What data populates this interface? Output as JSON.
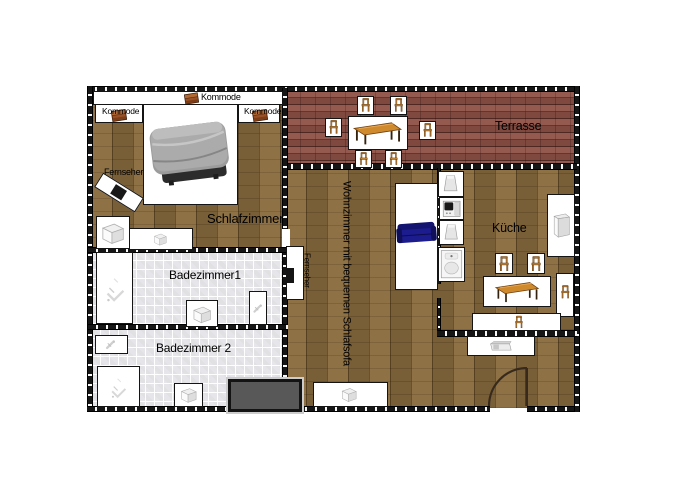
{
  "meta": {
    "type": "apartment-floor-plan",
    "background": "#ffffff",
    "width": 700,
    "height": 500
  },
  "colors": {
    "wood_floor": "#85683c",
    "brick_terrace": "#8e5146",
    "tile_bath": "#e6e6ea",
    "wall": "#161616",
    "furniture_fill": "#ffffff",
    "outline": "#141414",
    "sofa_blue": "#1c1c8e",
    "chair_tan": "#c08136",
    "table_top": "#d08a2e",
    "kommode_brown": "#9a5125",
    "platform_gray": "#585858",
    "tv_black": "#141414"
  },
  "rooms": [
    {
      "name": "schlafzimmer",
      "floor": "wood",
      "x": 91,
      "y": 91,
      "w": 195,
      "h": 160
    },
    {
      "name": "terrasse",
      "floor": "brick",
      "x": 285,
      "y": 91,
      "w": 291,
      "h": 77
    },
    {
      "name": "wohnzimmer",
      "floor": "wood",
      "x": 285,
      "y": 166,
      "w": 292,
      "h": 242
    },
    {
      "name": "badezimmer1",
      "floor": "tile",
      "x": 91,
      "y": 251,
      "w": 192,
      "h": 76
    },
    {
      "name": "badezimmer2",
      "floor": "tile",
      "x": 91,
      "y": 329,
      "w": 192,
      "h": 79
    }
  ],
  "walls": [
    {
      "name": "wall-top",
      "o": "h",
      "x": 87,
      "y": 86,
      "w": 493,
      "h": 6
    },
    {
      "name": "wall-left",
      "o": "v",
      "x": 87,
      "y": 86,
      "w": 6,
      "h": 326
    },
    {
      "name": "wall-bottom-left",
      "o": "h",
      "x": 87,
      "y": 406,
      "w": 403,
      "h": 6
    },
    {
      "name": "wall-bottom-right",
      "o": "h",
      "x": 527,
      "y": 406,
      "w": 53,
      "h": 6
    },
    {
      "name": "wall-right",
      "o": "v",
      "x": 574,
      "y": 86,
      "w": 6,
      "h": 326
    },
    {
      "name": "wall-terrace-bottom",
      "o": "h",
      "x": 283,
      "y": 163,
      "w": 294,
      "h": 7
    },
    {
      "name": "wall-bedroom-right",
      "o": "v",
      "x": 282,
      "y": 88,
      "w": 6,
      "h": 141
    },
    {
      "name": "wall-bath-right",
      "o": "v",
      "x": 282,
      "y": 247,
      "w": 6,
      "h": 137
    },
    {
      "name": "wall-bedroom-bottom",
      "o": "h",
      "x": 88,
      "y": 247,
      "w": 200,
      "h": 6
    },
    {
      "name": "wall-bath-divider",
      "o": "h",
      "x": 88,
      "y": 324,
      "w": 200,
      "h": 6
    },
    {
      "name": "wall-kitchen-left-a",
      "o": "v",
      "x": 437,
      "y": 168,
      "w": 4,
      "h": 116
    },
    {
      "name": "wall-kitchen-left-b",
      "o": "v",
      "x": 437,
      "y": 298,
      "w": 4,
      "h": 36
    },
    {
      "name": "wall-kitchen-bottom",
      "o": "h",
      "x": 437,
      "y": 330,
      "w": 140,
      "h": 7
    }
  ],
  "door_gaps": [
    {
      "name": "door-gap-bedroom-living",
      "x": 282,
      "y": 229,
      "w": 8,
      "h": 18
    }
  ],
  "furniture": [
    {
      "t": "box",
      "name": "closet-strip",
      "x": 93,
      "y": 91,
      "w": 190,
      "h": 14
    },
    {
      "t": "kommode",
      "name": "kommode-icon-top",
      "x": 184,
      "y": 92,
      "w": 15,
      "h": 13
    },
    {
      "t": "box",
      "name": "kommode-box-left",
      "x": 95,
      "y": 104,
      "w": 48,
      "h": 19
    },
    {
      "t": "kommode",
      "name": "kommode-icon-left",
      "x": 111,
      "y": 109,
      "w": 16,
      "h": 13
    },
    {
      "t": "box",
      "name": "kommode-box-right",
      "x": 238,
      "y": 104,
      "w": 42,
      "h": 19
    },
    {
      "t": "kommode",
      "name": "kommode-icon-right",
      "x": 252,
      "y": 109,
      "w": 16,
      "h": 13
    },
    {
      "t": "bed",
      "name": "double-bed",
      "x": 143,
      "y": 104,
      "w": 95,
      "h": 101
    },
    {
      "t": "tvdiag",
      "name": "tv-bedroom",
      "x": 95,
      "y": 184,
      "w": 48,
      "h": 17,
      "rot": 32
    },
    {
      "t": "cabinet",
      "name": "wardrobe-1",
      "x": 96,
      "y": 216,
      "w": 34,
      "h": 33
    },
    {
      "t": "box",
      "name": "wardrobe-2-box",
      "x": 129,
      "y": 228,
      "w": 64,
      "h": 22
    },
    {
      "t": "cube",
      "name": "wardrobe-2-icon",
      "x": 151,
      "y": 230,
      "w": 19,
      "h": 18
    },
    {
      "t": "table",
      "name": "terrace-table",
      "x": 348,
      "y": 116,
      "w": 60,
      "h": 34
    },
    {
      "t": "chair",
      "name": "terrace-chair-1",
      "x": 357,
      "y": 96,
      "w": 17,
      "h": 19
    },
    {
      "t": "chair",
      "name": "terrace-chair-2",
      "x": 390,
      "y": 96,
      "w": 17,
      "h": 19
    },
    {
      "t": "chair",
      "name": "terrace-chair-3",
      "x": 325,
      "y": 118,
      "w": 17,
      "h": 19
    },
    {
      "t": "chair",
      "name": "terrace-chair-4",
      "x": 419,
      "y": 121,
      "w": 17,
      "h": 19
    },
    {
      "t": "chair",
      "name": "terrace-chair-5",
      "x": 355,
      "y": 150,
      "w": 17,
      "h": 18
    },
    {
      "t": "chair",
      "name": "terrace-chair-6",
      "x": 385,
      "y": 150,
      "w": 17,
      "h": 18
    },
    {
      "t": "tvside",
      "name": "tv-livingroom",
      "x": 286,
      "y": 246,
      "w": 18,
      "h": 54
    },
    {
      "t": "box",
      "name": "sofa-area",
      "x": 395,
      "y": 183,
      "w": 43,
      "h": 107
    },
    {
      "t": "sofa",
      "name": "schlafsofa",
      "x": 396,
      "y": 218,
      "w": 41,
      "h": 32
    },
    {
      "t": "box",
      "name": "sideboard-box",
      "x": 313,
      "y": 382,
      "w": 75,
      "h": 25
    },
    {
      "t": "cube",
      "name": "sideboard-icon",
      "x": 339,
      "y": 384,
      "w": 21,
      "h": 21
    },
    {
      "t": "desk",
      "name": "entry-desk",
      "x": 467,
      "y": 336,
      "w": 68,
      "h": 20
    },
    {
      "t": "trapz",
      "name": "appliance-fridge-top",
      "x": 438,
      "y": 171,
      "w": 26,
      "h": 26
    },
    {
      "t": "oven",
      "name": "appliance-oven",
      "x": 439,
      "y": 197,
      "w": 25,
      "h": 23
    },
    {
      "t": "trapz",
      "name": "appliance-mid",
      "x": 439,
      "y": 220,
      "w": 25,
      "h": 25
    },
    {
      "t": "sink",
      "name": "kitchen-sink",
      "x": 438,
      "y": 247,
      "w": 27,
      "h": 35
    },
    {
      "t": "fridge",
      "name": "fridge-tall",
      "x": 547,
      "y": 194,
      "w": 28,
      "h": 63
    },
    {
      "t": "table",
      "name": "kitchen-table",
      "x": 483,
      "y": 276,
      "w": 68,
      "h": 31
    },
    {
      "t": "chair",
      "name": "kitchen-chair-1",
      "x": 495,
      "y": 253,
      "w": 18,
      "h": 21
    },
    {
      "t": "chair",
      "name": "kitchen-chair-2",
      "x": 527,
      "y": 253,
      "w": 18,
      "h": 21
    },
    {
      "t": "box",
      "name": "kitchen-chair-right-strip",
      "x": 556,
      "y": 273,
      "w": 18,
      "h": 44
    },
    {
      "t": "chairicon",
      "name": "kitchen-chair-3",
      "x": 558,
      "y": 282,
      "w": 14,
      "h": 19
    },
    {
      "t": "box",
      "name": "kitchen-chair-bottom-strip",
      "x": 472,
      "y": 313,
      "w": 89,
      "h": 18
    },
    {
      "t": "chairicon",
      "name": "kitchen-chair-4",
      "x": 512,
      "y": 314,
      "w": 13,
      "h": 17
    },
    {
      "t": "shower",
      "name": "bath1-shower",
      "x": 96,
      "y": 252,
      "w": 37,
      "h": 72
    },
    {
      "t": "cubebox",
      "name": "bath1-toilet",
      "x": 186,
      "y": 300,
      "w": 32,
      "h": 27
    },
    {
      "t": "fixture",
      "name": "bath1-bidet",
      "x": 249,
      "y": 291,
      "w": 18,
      "h": 34
    },
    {
      "t": "fixture",
      "name": "bath2-sink",
      "x": 95,
      "y": 335,
      "w": 33,
      "h": 19
    },
    {
      "t": "shower",
      "name": "bath2-shower",
      "x": 97,
      "y": 366,
      "w": 43,
      "h": 41
    },
    {
      "t": "cubebox",
      "name": "bath2-toilet",
      "x": 174,
      "y": 383,
      "w": 29,
      "h": 24
    },
    {
      "t": "platform",
      "name": "entry-platform",
      "x": 228,
      "y": 379,
      "w": 74,
      "h": 33
    },
    {
      "t": "door",
      "name": "entrance-door",
      "x": 488,
      "y": 367,
      "w": 40,
      "h": 40
    }
  ],
  "labels": [
    {
      "text": "Kommode",
      "name": "label-kommode-top",
      "x": 201,
      "y": 93,
      "size": 9
    },
    {
      "text": "Kommode",
      "name": "label-kommode-left",
      "x": 102,
      "y": 107,
      "size": 8.5
    },
    {
      "text": "Kommode",
      "name": "label-kommode-right",
      "x": 244,
      "y": 107,
      "size": 8.5
    },
    {
      "text": "Fernseher",
      "name": "label-fernseher-bedroom",
      "x": 104,
      "y": 168,
      "size": 9
    },
    {
      "text": "Schlafzimmer",
      "name": "label-schlafzimmer",
      "x": 207,
      "y": 212,
      "size": 13
    },
    {
      "text": "Terrasse",
      "name": "label-terrasse",
      "x": 495,
      "y": 120,
      "size": 12.5
    },
    {
      "text": "Wohnzimmer mit bequemen Schlafsofa",
      "name": "label-wohnzimmer",
      "x": 340,
      "y": 181,
      "size": 11,
      "vertical": true
    },
    {
      "text": "Fernseher",
      "name": "label-fernseher-living",
      "x": 302,
      "y": 253,
      "size": 8,
      "vertical": true
    },
    {
      "text": "Küche",
      "name": "label-kueche",
      "x": 492,
      "y": 222,
      "size": 12.5
    },
    {
      "text": "Badezimmer1",
      "name": "label-badezimmer1",
      "x": 169,
      "y": 269,
      "size": 12
    },
    {
      "text": "Badezimmer 2",
      "name": "label-badezimmer2",
      "x": 156,
      "y": 342,
      "size": 12
    }
  ]
}
